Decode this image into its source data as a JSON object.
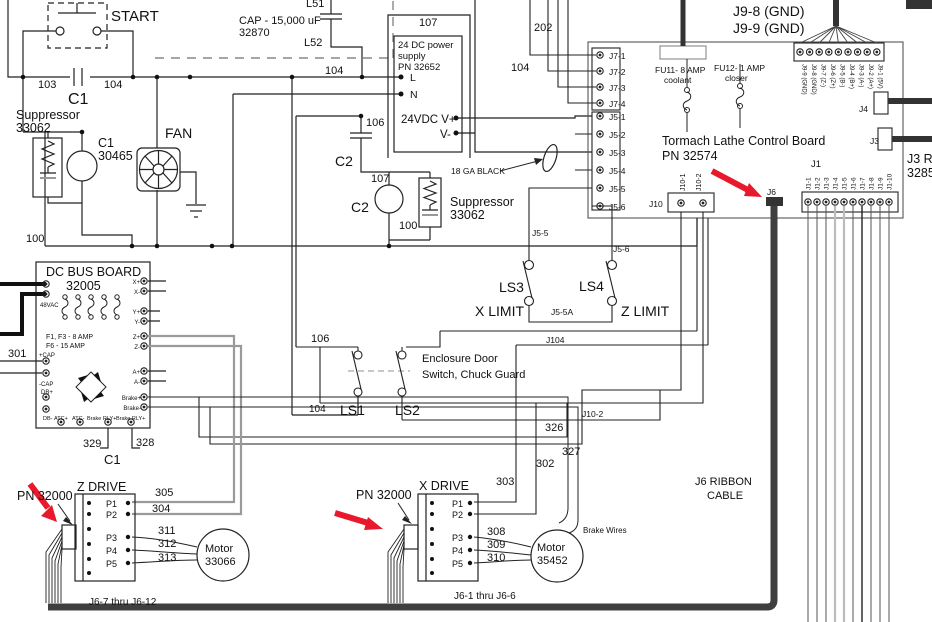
{
  "diagram": {
    "kind": "electrical wiring schematic",
    "subject": "Tormach Lathe Control Board wiring diagram",
    "colors": {
      "wire": "#222222",
      "gray_wire": "#9a9a9a",
      "cable": "#3f3f3f",
      "power_cable": "#111111",
      "accent_red": "#e8192c",
      "text": "#111111",
      "background": "#ffffff"
    },
    "red_arrow_count": 3
  },
  "labels": [
    {
      "n": "start-label",
      "t": "START",
      "x": 111,
      "y": 21,
      "s": 15
    },
    {
      "n": "wire-103",
      "t": "103",
      "x": 38,
      "y": 88,
      "s": 11
    },
    {
      "n": "wire-104-a",
      "t": "104",
      "x": 104,
      "y": 88,
      "s": 11
    },
    {
      "n": "c1-contact-label",
      "t": "C1",
      "x": 68,
      "y": 104,
      "s": 16
    },
    {
      "n": "suppressor1-name",
      "t": "Suppressor",
      "x": 16,
      "y": 119,
      "s": 12.5
    },
    {
      "n": "suppressor1-pn",
      "t": "33062",
      "x": 16,
      "y": 132,
      "s": 12.5
    },
    {
      "n": "c1-coil-name",
      "t": "C1",
      "x": 98,
      "y": 147,
      "s": 12.5
    },
    {
      "n": "c1-coil-pn",
      "t": "30465",
      "x": 98,
      "y": 160,
      "s": 12.5
    },
    {
      "n": "fan-label",
      "t": "FAN",
      "x": 165,
      "y": 138,
      "s": 14
    },
    {
      "n": "wire-100-a",
      "t": "100",
      "x": 26,
      "y": 242,
      "s": 11
    },
    {
      "n": "cap-label",
      "t": "CAP - 15,000 uF",
      "x": 239,
      "y": 24,
      "s": 11
    },
    {
      "n": "cap-pn",
      "t": "32870",
      "x": 239,
      "y": 36,
      "s": 11
    },
    {
      "n": "l51-label",
      "t": "L51",
      "x": 306,
      "y": 7,
      "s": 11
    },
    {
      "n": "l52-label",
      "t": "L52",
      "x": 304,
      "y": 46,
      "s": 11
    },
    {
      "n": "wire-104-b",
      "t": "104",
      "x": 325,
      "y": 74,
      "s": 11
    },
    {
      "n": "wire-107-a",
      "t": "107",
      "x": 419,
      "y": 26,
      "s": 11
    },
    {
      "n": "wire-202",
      "t": "202",
      "x": 534,
      "y": 31,
      "s": 11
    },
    {
      "n": "wire-104-c",
      "t": "104",
      "x": 511,
      "y": 71,
      "s": 11
    },
    {
      "n": "ps-name-1",
      "t": "24 DC power",
      "x": 398,
      "y": 48,
      "s": 9.5
    },
    {
      "n": "ps-name-2",
      "t": "supply",
      "x": 398,
      "y": 59,
      "s": 9.5
    },
    {
      "n": "ps-pn",
      "t": "PN 32652",
      "x": 398,
      "y": 70,
      "s": 9.5
    },
    {
      "n": "ps-terminal-l",
      "t": "L",
      "x": 410,
      "y": 81,
      "s": 10.5
    },
    {
      "n": "ps-terminal-n",
      "t": "N",
      "x": 410,
      "y": 98,
      "s": 10.5
    },
    {
      "n": "ps-24vdc",
      "t": "24VDC V+",
      "x": 401,
      "y": 123,
      "s": 11.5
    },
    {
      "n": "ps-vminus",
      "t": "V-",
      "x": 440,
      "y": 138,
      "s": 11.5
    },
    {
      "n": "wire-106-a",
      "t": "106",
      "x": 366,
      "y": 126,
      "s": 11
    },
    {
      "n": "c2-cap-label",
      "t": "C2",
      "x": 335,
      "y": 166,
      "s": 14
    },
    {
      "n": "wire-107-b",
      "t": "107",
      "x": 371,
      "y": 182,
      "s": 11
    },
    {
      "n": "c2-coil-label",
      "t": "C2",
      "x": 351,
      "y": 212,
      "s": 14
    },
    {
      "n": "ga-black-label",
      "t": "18 GA BLACK",
      "x": 451,
      "y": 174,
      "s": 8.5
    },
    {
      "n": "suppressor2-name",
      "t": "Suppressor",
      "x": 450,
      "y": 206,
      "s": 12.5
    },
    {
      "n": "suppressor2-pn",
      "t": "33062",
      "x": 450,
      "y": 219,
      "s": 12.5
    },
    {
      "n": "wire-100-b",
      "t": "100",
      "x": 399,
      "y": 229,
      "s": 11
    },
    {
      "n": "wire-j5-5",
      "t": "J5-5",
      "x": 532,
      "y": 236,
      "s": 8.5
    },
    {
      "n": "wire-j5-6",
      "t": "J5-6",
      "x": 613,
      "y": 252,
      "s": 8.5
    },
    {
      "n": "ls3-label",
      "t": "LS3",
      "x": 499,
      "y": 292,
      "s": 14
    },
    {
      "n": "ls4-label",
      "t": "LS4",
      "x": 579,
      "y": 291,
      "s": 14
    },
    {
      "n": "x-limit-label",
      "t": "X LIMIT",
      "x": 475,
      "y": 316,
      "s": 14
    },
    {
      "n": "z-limit-label",
      "t": "Z LIMIT",
      "x": 621,
      "y": 316,
      "s": 14
    },
    {
      "n": "wire-j5-5a",
      "t": "J5-5A",
      "x": 551,
      "y": 315,
      "s": 8.5
    },
    {
      "n": "wire-j104",
      "t": "J104",
      "x": 546,
      "y": 343,
      "s": 8.5
    },
    {
      "n": "j9-8-gnd",
      "t": "J9-8 (GND)",
      "x": 733,
      "y": 16,
      "s": 14
    },
    {
      "n": "j9-9-gnd",
      "t": "J9-9 (GND)",
      "x": 733,
      "y": 33,
      "s": 14
    },
    {
      "n": "j7-1",
      "t": "J7-1",
      "x": 609,
      "y": 59,
      "s": 8.5
    },
    {
      "n": "j7-2",
      "t": "J7-2",
      "x": 609,
      "y": 75,
      "s": 8.5
    },
    {
      "n": "j7-3",
      "t": "J7-3",
      "x": 609,
      "y": 91,
      "s": 8.5
    },
    {
      "n": "j7-4",
      "t": "J7-4",
      "x": 609,
      "y": 107,
      "s": 8.5
    },
    {
      "n": "j5-1",
      "t": "J5-1",
      "x": 609,
      "y": 120,
      "s": 8.5
    },
    {
      "n": "j5-2",
      "t": "J5-2",
      "x": 609,
      "y": 138,
      "s": 8.5
    },
    {
      "n": "j5-3",
      "t": "J5-3",
      "x": 609,
      "y": 156,
      "s": 8.5
    },
    {
      "n": "j5-4",
      "t": "J5-4",
      "x": 609,
      "y": 174,
      "s": 8.5
    },
    {
      "n": "j5-5",
      "t": "J5-5",
      "x": 609,
      "y": 192,
      "s": 8.5
    },
    {
      "n": "j5-6",
      "t": "J5-6",
      "x": 609,
      "y": 210,
      "s": 8.5
    },
    {
      "n": "fu11-label",
      "t": "FU11- 8 AMP",
      "x": 655,
      "y": 73,
      "s": 8.5
    },
    {
      "n": "fu11-sub",
      "t": "coolant",
      "x": 664,
      "y": 83,
      "s": 8.5
    },
    {
      "n": "fu12-label",
      "t": "FU12- 1 AMP",
      "x": 714,
      "y": 71,
      "s": 8.5
    },
    {
      "n": "fu12-sub",
      "t": "closer",
      "x": 725,
      "y": 81,
      "s": 8.5
    },
    {
      "n": "board-name",
      "t": "Tormach Lathe Control Board",
      "x": 662,
      "y": 145,
      "s": 12.5
    },
    {
      "n": "board-pn",
      "t": "PN 32574",
      "x": 662,
      "y": 160,
      "s": 12.5
    },
    {
      "n": "j10-label",
      "t": "J10",
      "x": 649,
      "y": 207,
      "s": 8.5
    },
    {
      "n": "j10-1-pin",
      "t": "J10-1",
      "x": 685,
      "y": 191,
      "s": 7,
      "r": -90
    },
    {
      "n": "j10-2-pin",
      "t": "J10-2",
      "x": 701,
      "y": 191,
      "s": 7,
      "r": -90
    },
    {
      "n": "j6-label",
      "t": "J6",
      "x": 767,
      "y": 195,
      "s": 8.5
    },
    {
      "n": "j1-label",
      "t": "J1",
      "x": 811,
      "y": 167,
      "s": 9.5
    },
    {
      "n": "j1-1-pin",
      "t": "J1-1",
      "x": 810.5,
      "y": 190,
      "s": 6.5,
      "r": -90
    },
    {
      "n": "j1-2-pin",
      "t": "J1-2",
      "x": 819.5,
      "y": 190,
      "s": 6.5,
      "r": -90
    },
    {
      "n": "j1-3-pin",
      "t": "J1-3",
      "x": 828.5,
      "y": 190,
      "s": 6.5,
      "r": -90
    },
    {
      "n": "j1-4-pin",
      "t": "J1-4",
      "x": 837.5,
      "y": 190,
      "s": 6.5,
      "r": -90
    },
    {
      "n": "j1-5-pin",
      "t": "J1-5",
      "x": 846.5,
      "y": 190,
      "s": 6.5,
      "r": -90
    },
    {
      "n": "j1-6-pin",
      "t": "J1-6",
      "x": 855.5,
      "y": 190,
      "s": 6.5,
      "r": -90
    },
    {
      "n": "j1-7-pin",
      "t": "J1-7",
      "x": 864.5,
      "y": 190,
      "s": 6.5,
      "r": -90
    },
    {
      "n": "j1-8-pin",
      "t": "J1-8",
      "x": 873.5,
      "y": 190,
      "s": 6.5,
      "r": -90
    },
    {
      "n": "j1-9-pin",
      "t": "J1-9",
      "x": 882.5,
      "y": 190,
      "s": 6.5,
      "r": -90
    },
    {
      "n": "j1-10-pin",
      "t": "J1-10",
      "x": 891.5,
      "y": 190,
      "s": 6.5,
      "r": -90
    },
    {
      "n": "j9-9-pin",
      "t": "J9-9 (GND)",
      "x": 802.5,
      "y": 64,
      "s": 6,
      "r": 90
    },
    {
      "n": "j9-8-pin",
      "t": "J9-8 (GND)",
      "x": 812,
      "y": 64,
      "s": 6,
      "r": 90
    },
    {
      "n": "j9-7-pin",
      "t": "J9-7 (Z-)",
      "x": 821.5,
      "y": 64,
      "s": 6,
      "r": 90
    },
    {
      "n": "j9-6-pin",
      "t": "J9-6 (Z+)",
      "x": 831,
      "y": 64,
      "s": 6,
      "r": 90
    },
    {
      "n": "j9-5-pin",
      "t": "J9-5 (B-)",
      "x": 840.5,
      "y": 64,
      "s": 6,
      "r": 90
    },
    {
      "n": "j9-4-pin",
      "t": "J9-4 (B+)",
      "x": 850,
      "y": 64,
      "s": 6,
      "r": 90
    },
    {
      "n": "j9-3-pin",
      "t": "J9-3 (A-)",
      "x": 859.5,
      "y": 64,
      "s": 6,
      "r": 90
    },
    {
      "n": "j9-2-pin",
      "t": "J9-2 (A+)",
      "x": 869,
      "y": 64,
      "s": 6,
      "r": 90
    },
    {
      "n": "j9-1-pin",
      "t": "J9-1 (5V)",
      "x": 878.5,
      "y": 64,
      "s": 6,
      "r": 90
    },
    {
      "n": "j4-label",
      "t": "J4",
      "x": 859,
      "y": 112,
      "s": 8.5
    },
    {
      "n": "j3-label",
      "t": "J3",
      "x": 870,
      "y": 144,
      "s": 8.5
    },
    {
      "n": "j3-r-label",
      "t": "J3 R",
      "x": 907,
      "y": 163,
      "s": 12.5
    },
    {
      "n": "j3-pn",
      "t": "3285",
      "x": 907,
      "y": 177,
      "s": 12.5
    },
    {
      "n": "dcbus-name",
      "t": "DC BUS BOARD",
      "x": 46,
      "y": 276,
      "s": 12.5
    },
    {
      "n": "dcbus-pn",
      "t": "32005",
      "x": 66,
      "y": 290,
      "s": 12.5
    },
    {
      "n": "dcbus-48vac",
      "t": "48VAC",
      "x": 40,
      "y": 307,
      "s": 6
    },
    {
      "n": "dcbus-f1f3",
      "t": "F1, F3 - 8 AMP",
      "x": 46,
      "y": 339,
      "s": 7
    },
    {
      "n": "dcbus-f6",
      "t": "F6 - 15 AMP",
      "x": 46,
      "y": 348,
      "s": 7
    },
    {
      "n": "dcbus-pcap",
      "t": "+CAP",
      "x": 39,
      "y": 357,
      "s": 6
    },
    {
      "n": "dcbus-ncap",
      "t": "-CAP",
      "x": 39,
      "y": 386,
      "s": 6
    },
    {
      "n": "dcbus-dbplus",
      "t": "DB+",
      "x": 41,
      "y": 394,
      "s": 6
    },
    {
      "n": "dcbus-dbminus",
      "t": "DB-",
      "x": 43,
      "y": 420,
      "s": 5.5
    },
    {
      "n": "dcbus-atcplus",
      "t": "ATC+",
      "x": 54,
      "y": 420,
      "s": 5.5
    },
    {
      "n": "dcbus-atcminus",
      "t": "ATC-",
      "x": 72,
      "y": 420,
      "s": 5.5
    },
    {
      "n": "dcbus-brakerly1",
      "t": "Brake RLY+",
      "x": 87,
      "y": 420,
      "s": 5.5
    },
    {
      "n": "dcbus-brakerly2",
      "t": "Brake RLY+",
      "x": 116,
      "y": 420,
      "s": 5.5
    },
    {
      "n": "dcbus-xplus",
      "t": "X+",
      "x": 140,
      "y": 284,
      "s": 6,
      "a": "end"
    },
    {
      "n": "dcbus-xminus",
      "t": "X-",
      "x": 140,
      "y": 294,
      "s": 6,
      "a": "end"
    },
    {
      "n": "dcbus-yplus",
      "t": "Y+",
      "x": 140,
      "y": 314,
      "s": 6,
      "a": "end"
    },
    {
      "n": "dcbus-yminus",
      "t": "Y-",
      "x": 140,
      "y": 324,
      "s": 6,
      "a": "end"
    },
    {
      "n": "dcbus-zplus",
      "t": "Z+",
      "x": 140,
      "y": 339,
      "s": 6,
      "a": "end"
    },
    {
      "n": "dcbus-zminus",
      "t": "Z-",
      "x": 140,
      "y": 349,
      "s": 6,
      "a": "end"
    },
    {
      "n": "dcbus-aplus",
      "t": "A+",
      "x": 140,
      "y": 374,
      "s": 6,
      "a": "end"
    },
    {
      "n": "dcbus-aminus",
      "t": "A-",
      "x": 140,
      "y": 384,
      "s": 6,
      "a": "end"
    },
    {
      "n": "dcbus-brakeplus",
      "t": "Brake+",
      "x": 141,
      "y": 400,
      "s": 6,
      "a": "end"
    },
    {
      "n": "dcbus-brakeminus",
      "t": "Brake-",
      "x": 141,
      "y": 410,
      "s": 6,
      "a": "end"
    },
    {
      "n": "wire-301",
      "t": "301",
      "x": 8,
      "y": 357,
      "s": 11
    },
    {
      "n": "wire-329",
      "t": "329",
      "x": 83,
      "y": 447,
      "s": 11
    },
    {
      "n": "wire-328",
      "t": "328",
      "x": 136,
      "y": 446,
      "s": 11
    },
    {
      "n": "c1-bottom-label",
      "t": "C1",
      "x": 104,
      "y": 464,
      "s": 13
    },
    {
      "n": "enclosure-1",
      "t": "Enclosure Door",
      "x": 422,
      "y": 362,
      "s": 11
    },
    {
      "n": "enclosure-2",
      "t": "Switch, Chuck Guard",
      "x": 422,
      "y": 378,
      "s": 11
    },
    {
      "n": "wire-106-b",
      "t": "106",
      "x": 311,
      "y": 342,
      "s": 11
    },
    {
      "n": "ls1-label",
      "t": "LS1",
      "x": 340,
      "y": 415,
      "s": 14
    },
    {
      "n": "ls2-label",
      "t": "LS2",
      "x": 395,
      "y": 415,
      "s": 14
    },
    {
      "n": "wire-104-d",
      "t": "104",
      "x": 309,
      "y": 412,
      "s": 10
    },
    {
      "n": "wire-326",
      "t": "326",
      "x": 545,
      "y": 431,
      "s": 11
    },
    {
      "n": "wire-327",
      "t": "327",
      "x": 562,
      "y": 455,
      "s": 11
    },
    {
      "n": "wire-302",
      "t": "302",
      "x": 536,
      "y": 467,
      "s": 11
    },
    {
      "n": "wire-303",
      "t": "303",
      "x": 496,
      "y": 485,
      "s": 11
    },
    {
      "n": "wire-j10-2",
      "t": "J10-2",
      "x": 582,
      "y": 417,
      "s": 8.5
    },
    {
      "n": "z-pn32000",
      "t": "PN 32000",
      "x": 17,
      "y": 500,
      "s": 12.5
    },
    {
      "n": "z-drive-label",
      "t": "Z DRIVE",
      "x": 77,
      "y": 491,
      "s": 12.5
    },
    {
      "n": "z-p1",
      "t": "P1",
      "x": 106,
      "y": 507,
      "s": 9
    },
    {
      "n": "z-p2",
      "t": "P2",
      "x": 106,
      "y": 518,
      "s": 9
    },
    {
      "n": "z-p3",
      "t": "P3",
      "x": 106,
      "y": 541,
      "s": 9
    },
    {
      "n": "z-p4",
      "t": "P4",
      "x": 106,
      "y": 554,
      "s": 9
    },
    {
      "n": "z-p5",
      "t": "P5",
      "x": 106,
      "y": 567,
      "s": 9
    },
    {
      "n": "wire-305",
      "t": "305",
      "x": 155,
      "y": 496,
      "s": 11
    },
    {
      "n": "wire-304",
      "t": "304",
      "x": 152,
      "y": 512,
      "s": 11
    },
    {
      "n": "wire-311",
      "t": "311",
      "x": 158,
      "y": 534,
      "s": 11
    },
    {
      "n": "wire-312",
      "t": "312",
      "x": 158,
      "y": 547,
      "s": 11
    },
    {
      "n": "wire-313",
      "t": "313",
      "x": 158,
      "y": 561,
      "s": 11
    },
    {
      "n": "z-motor-name",
      "t": "Motor",
      "x": 205,
      "y": 552,
      "s": 11
    },
    {
      "n": "z-motor-pn",
      "t": "33066",
      "x": 205,
      "y": 565,
      "s": 11
    },
    {
      "n": "j6-7-12-label",
      "t": "J6-7 thru J6-12",
      "x": 89,
      "y": 605,
      "s": 10
    },
    {
      "n": "x-pn32000",
      "t": "PN 32000",
      "x": 356,
      "y": 499,
      "s": 12.5
    },
    {
      "n": "x-drive-label",
      "t": "X DRIVE",
      "x": 419,
      "y": 490,
      "s": 12.5
    },
    {
      "n": "x-p1",
      "t": "P1",
      "x": 452,
      "y": 507,
      "s": 9
    },
    {
      "n": "x-p2",
      "t": "P2",
      "x": 452,
      "y": 518,
      "s": 9
    },
    {
      "n": "x-p3",
      "t": "P3",
      "x": 452,
      "y": 541,
      "s": 9
    },
    {
      "n": "x-p4",
      "t": "P4",
      "x": 452,
      "y": 554,
      "s": 9
    },
    {
      "n": "x-p5",
      "t": "P5",
      "x": 452,
      "y": 567,
      "s": 9
    },
    {
      "n": "wire-308",
      "t": "308",
      "x": 487,
      "y": 535,
      "s": 11
    },
    {
      "n": "wire-309",
      "t": "309",
      "x": 487,
      "y": 548,
      "s": 11
    },
    {
      "n": "wire-310",
      "t": "310",
      "x": 487,
      "y": 561,
      "s": 11
    },
    {
      "n": "x-motor-name",
      "t": "Motor",
      "x": 537,
      "y": 551,
      "s": 11
    },
    {
      "n": "x-motor-pn",
      "t": "35452",
      "x": 537,
      "y": 564,
      "s": 11
    },
    {
      "n": "brake-wires-label",
      "t": "Brake Wires",
      "x": 583,
      "y": 533,
      "s": 8
    },
    {
      "n": "j6-1-6-label",
      "t": "J6-1 thru J6-6",
      "x": 454,
      "y": 599,
      "s": 10
    },
    {
      "n": "j6-ribbon-1",
      "t": "J6 RIBBON",
      "x": 695,
      "y": 485,
      "s": 11
    },
    {
      "n": "j6-ribbon-2",
      "t": "CABLE",
      "x": 707,
      "y": 499,
      "s": 11
    }
  ]
}
